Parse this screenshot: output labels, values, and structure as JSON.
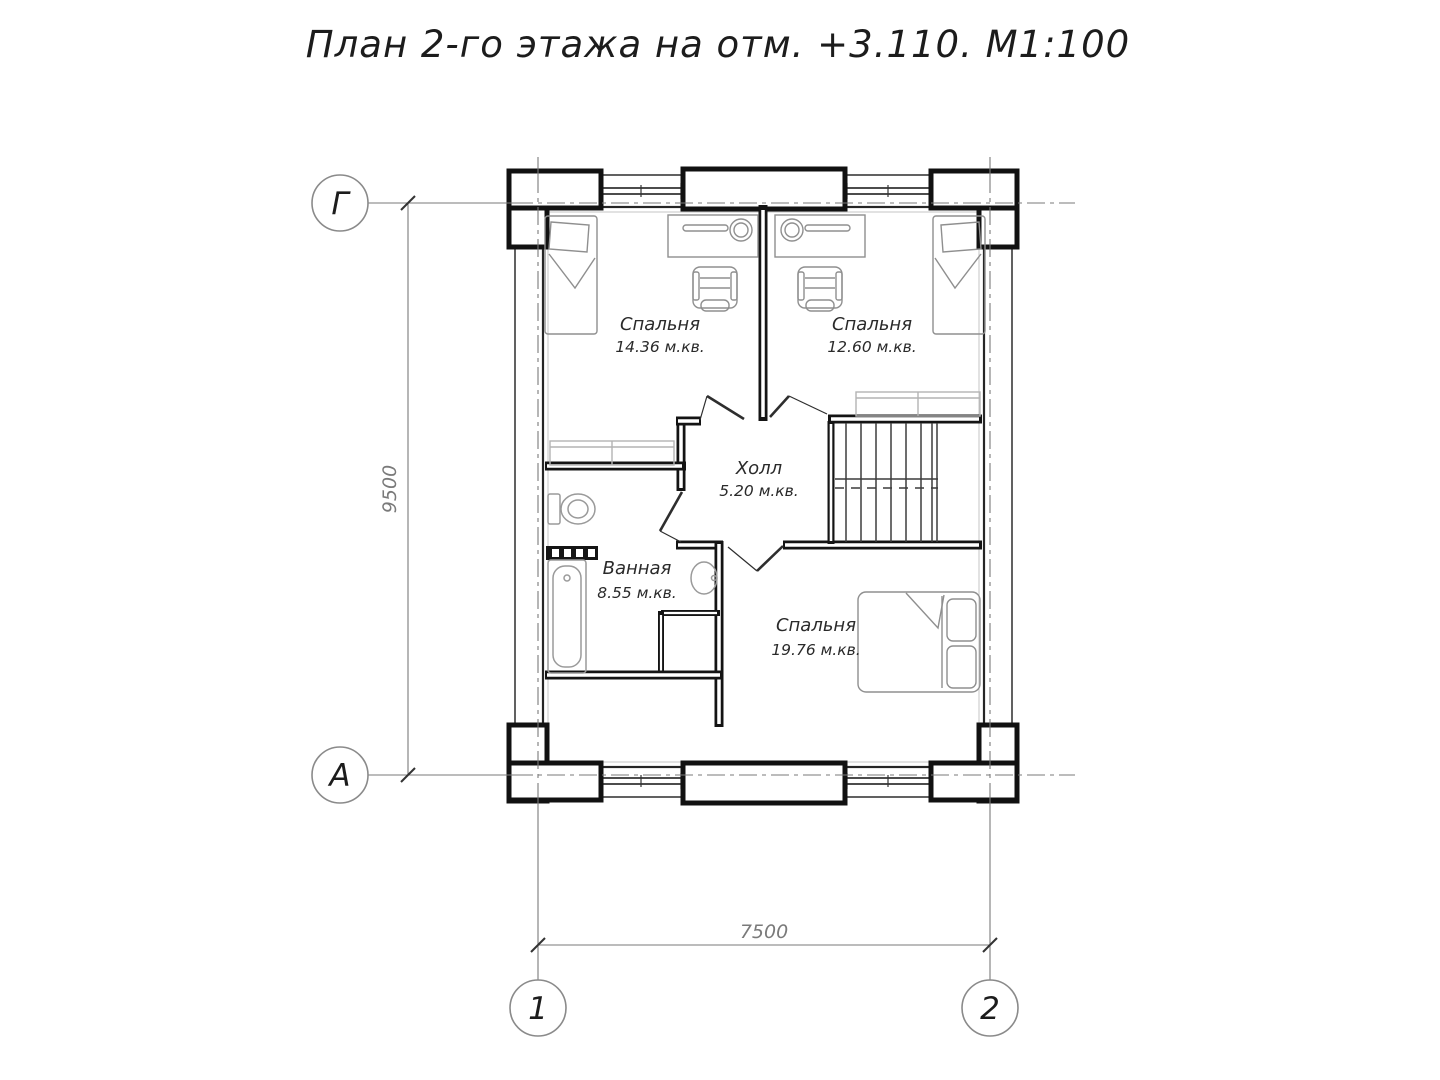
{
  "title": "План 2-го этажа на отм. +3.110. М1:100",
  "grid": {
    "row_top": "Г",
    "row_bottom": "А",
    "col_left": "1",
    "col_right": "2"
  },
  "dimensions": {
    "vertical": "9500",
    "horizontal": "7500"
  },
  "rooms": {
    "bedroom1": {
      "name": "Спальня",
      "area": "14.36 м.кв."
    },
    "bedroom2": {
      "name": "Спальня",
      "area": "12.60 м.кв."
    },
    "hall": {
      "name": "Холл",
      "area": "5.20 м.кв."
    },
    "bathroom": {
      "name": "Ванная",
      "area": "8.55 м.кв."
    },
    "bedroom3": {
      "name": "Спальня",
      "area": "19.76 м.кв."
    }
  },
  "colors": {
    "background": "#ffffff",
    "wall_ink": "#141414",
    "thin_ink": "#3a3a3a",
    "furniture_gray": "#8f8f8f",
    "dimension_gray": "#7a7a7a"
  }
}
